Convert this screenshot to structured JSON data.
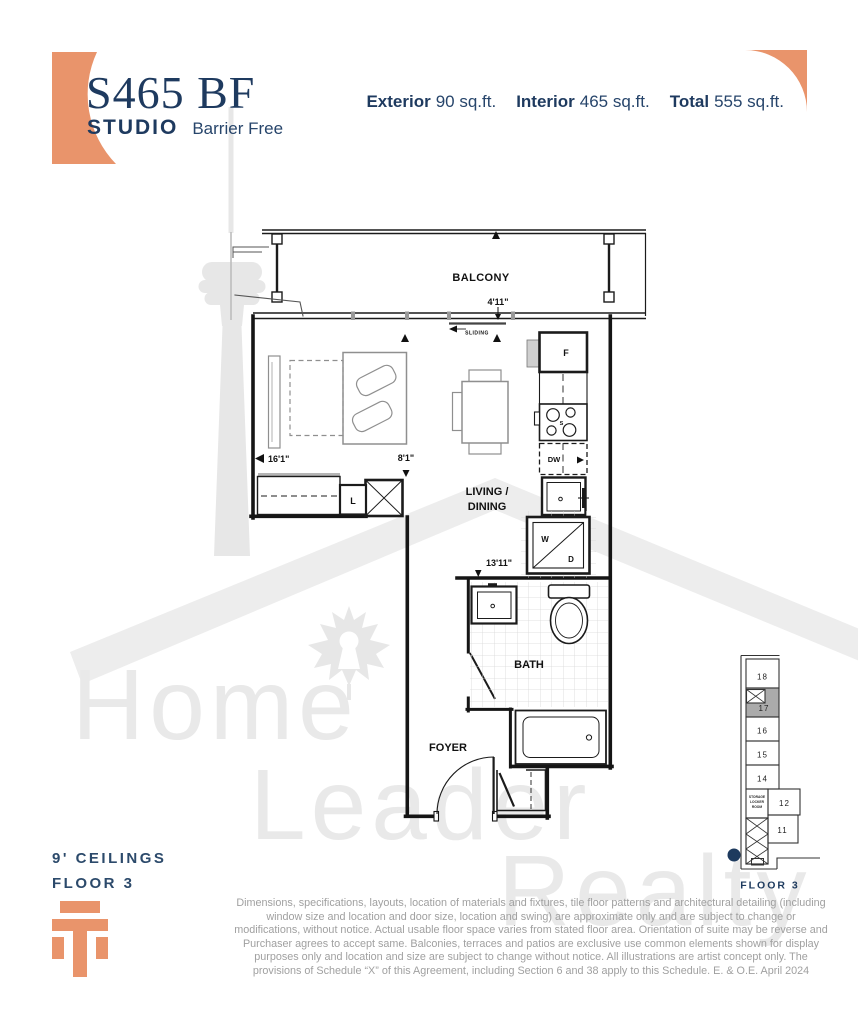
{
  "header": {
    "unit_code": "S465 BF",
    "unit_type": "STUDIO",
    "unit_variant": "Barrier Free",
    "stats": [
      {
        "label": "Exterior",
        "value": "90 sq.ft."
      },
      {
        "label": "Interior",
        "value": "465 sq.ft."
      },
      {
        "label": "Total",
        "value": "555 sq.ft."
      }
    ]
  },
  "floorplan": {
    "room_labels": {
      "balcony": "BALCONY",
      "living_line1": "LIVING /",
      "living_line2": "DINING",
      "bath": "BATH",
      "foyer": "FOYER"
    },
    "dimensions": {
      "balcony_door": "4'11\"",
      "bedroom_width": "16'1\"",
      "hall_width": "8'1\"",
      "bath_wall": "13'11\""
    },
    "fixtures": {
      "fridge": "F",
      "stove": "S",
      "dishwasher": "DW",
      "washer": "W",
      "dryer": "D",
      "linen_closet": "L",
      "sliding_door": "SLIDING"
    }
  },
  "keyplan": {
    "units": [
      {
        "number": "18",
        "highlighted": false
      },
      {
        "number": "17",
        "highlighted": true
      },
      {
        "number": "16",
        "highlighted": false
      },
      {
        "number": "15",
        "highlighted": false
      },
      {
        "number": "14",
        "highlighted": false
      },
      {
        "number": "12",
        "highlighted": false
      },
      {
        "number": "11",
        "highlighted": false
      }
    ],
    "storage_room": [
      "STORAGE",
      "LOCKER",
      "ROOM"
    ],
    "floor_label": "FLOOR 3"
  },
  "notes": {
    "ceiling": "9' CEILINGS",
    "floor": "FLOOR 3"
  },
  "watermark": {
    "words": [
      "Home",
      "Leader",
      "Realty"
    ]
  },
  "disclaimer": "Dimensions, specifications, layouts, location of materials and fixtures, tile floor patterns and architectural detailing (including window size and location and door size, location and swing) are approximate only and are subject to change or modifications, without notice. Actual usable floor space varies from stated floor area. Orientation of suite may be reverse and Purchaser agrees to accept same. Balconies, terraces and patios are exclusive use common elements shown for display purposes only and location and size are subject to change without notice. All illustrations are artist concept only. The provisions of Schedule “X” of this Agreement, including Section 6 and 38 apply to this Schedule. E. & O.E. April 2024",
  "colors": {
    "accent_orange": "#E9946B",
    "navy": "#1e3a5f",
    "plan_line": "#1b1b1b",
    "watermark_gray": "#e9e9e9",
    "highlighted_unit_gray": "#ababab"
  }
}
